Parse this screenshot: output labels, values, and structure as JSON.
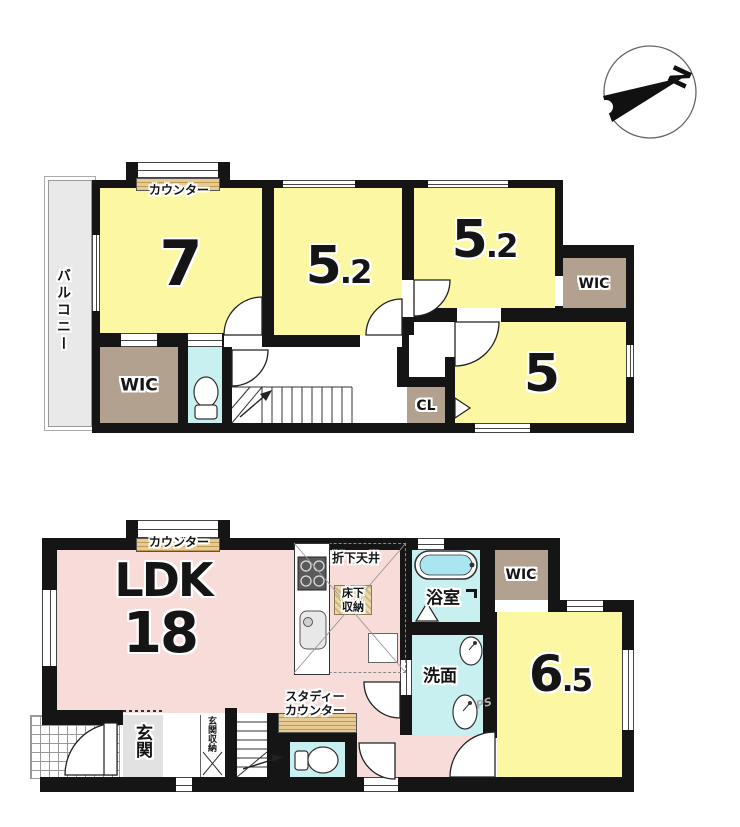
{
  "palette": {
    "wall": "#151515",
    "room_yellow": "#fbf7a2",
    "ldk_pink": "#f8dcda",
    "wet_cyan": "#c8f0f1",
    "closet_brown": "#b3a190",
    "balcony_gray": "#e9e9e9",
    "counter_wood": "#d8b97d"
  },
  "compass": {
    "north": "N"
  },
  "floor2": {
    "balcony": "バルコニー",
    "counter": "カウンター",
    "room7": "7",
    "room52_mid": {
      "whole": "5",
      "fraction": ".2"
    },
    "room52_right": {
      "whole": "5",
      "fraction": ".2"
    },
    "wic_right": "WIC",
    "wic_left": "WIC",
    "room5": "5",
    "closet": "CL"
  },
  "floor1": {
    "counter": "カウンター",
    "ldk_name": "LDK",
    "ldk_size": "18",
    "dropped_ceiling": "折下天井",
    "underfloor_storage": {
      "line1": "床下",
      "line2": "収納"
    },
    "bathroom": "浴室",
    "washroom": "洗面",
    "wic": "WIC",
    "pipe_space": "PS",
    "room65": {
      "whole": "6",
      "fraction": ".5"
    },
    "study_counter": {
      "line1": "スタディー",
      "line2": "カウンター"
    },
    "entrance": "玄関",
    "entrance_storage": "玄関収納"
  }
}
